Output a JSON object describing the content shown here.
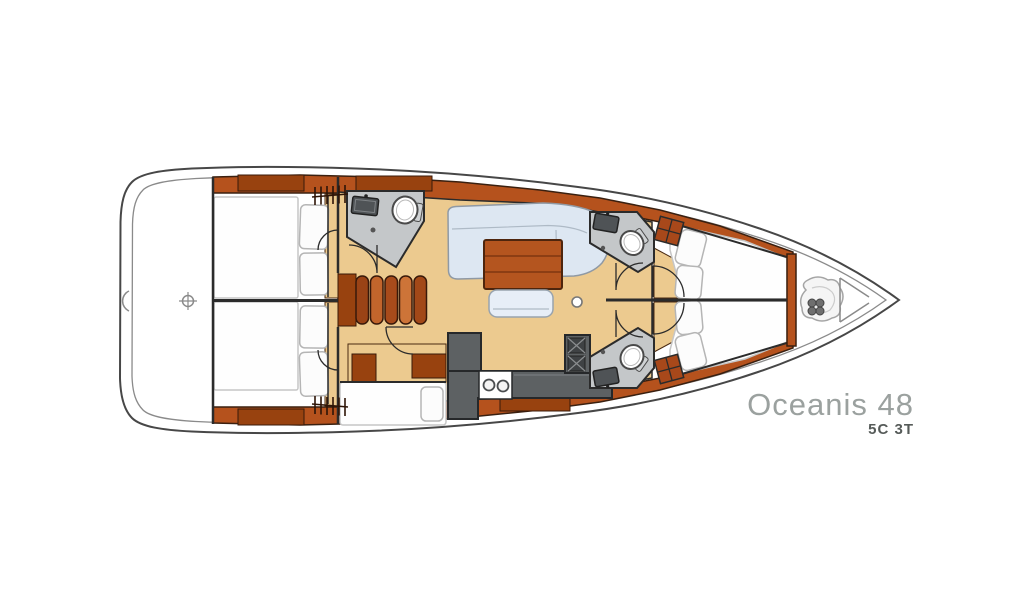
{
  "plan": {
    "model": "Oceanis 48",
    "variant": "5C 3T"
  },
  "colors": {
    "hull_line": "#474747",
    "cabinet_wood": "#b5521d",
    "cabinet_wood_dark": "#98420f",
    "floor_wood": "#ecca8f",
    "counter_gray": "#c4c7c9",
    "galley_counter": "#5d6163",
    "sofa_upholstery": "#dde7f2",
    "table_wood": "#b4551f",
    "bed_linen": "#fefefe",
    "model_text": "#9ba19f",
    "variant_text": "#565b59"
  }
}
